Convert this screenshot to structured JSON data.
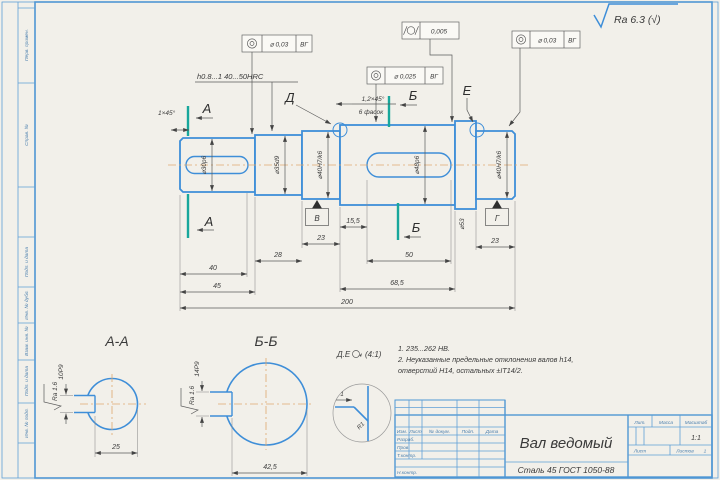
{
  "surface_finish": "Ra 6.3 (√)",
  "shaft_view": {
    "hardness_note": "h0.8...1 40...50HRC",
    "chamfer_left": "1×45°",
    "chamfer_right": "1,2×45°",
    "chamfer_right2": "6 фасок",
    "cut_a": "А",
    "cut_b": "Б",
    "detail_d": "Д",
    "detail_e": "Е",
    "datum_v": "В",
    "datum_g": "Г",
    "dia_30": "⌀30p6",
    "dia_35": "⌀35d9",
    "dia_40_left": "⌀40H7/k6",
    "dia_48": "⌀48p6",
    "dia_53": "⌀53",
    "dia_40_right": "⌀40H7/k6",
    "dim_15_5": "15,5",
    "dim_23_left": "23",
    "dim_28": "28",
    "dim_40": "40",
    "dim_45": "45",
    "dim_50": "50",
    "dim_68_5": "68,5",
    "dim_200": "200",
    "dim_23_right": "23"
  },
  "tolerances": {
    "f1": {
      "value": "⌀ 0,03",
      "datum": "ВГ"
    },
    "f2": {
      "value": "0,005"
    },
    "f3": {
      "value": "⌀ 0,025",
      "datum": "ВГ"
    },
    "f4": {
      "value": "⌀ 0,03",
      "datum": "ВГ"
    }
  },
  "section_aa": {
    "title": "А-А",
    "keyway": "10P9",
    "width": "25",
    "roughness": "Ra 1.6"
  },
  "section_bb": {
    "title": "Б-Б",
    "keyway": "14P9",
    "width": "42,5",
    "roughness": "Ra 1.6"
  },
  "detail": {
    "label": "Д.Е",
    "scale": "(4:1)",
    "radius": "R1",
    "dim": "1"
  },
  "notes": {
    "line1": "1. 235...262 НВ.",
    "line2": "2. Неуказанные предельные отклонения валов h14,",
    "line3": "отверстий Н14, остальных ±IT14/2."
  },
  "title_block": {
    "name": "Вал ведомый",
    "material": "Сталь 45 ГОСТ 1050-88",
    "col_izm": "Изм.",
    "col_list": "Лист",
    "col_dokum": "№ докум.",
    "col_podp": "Подп.",
    "col_data": "Дата",
    "row_razrab": "Разраб.",
    "row_prov": "Пров.",
    "row_tkontr": "Т.контр.",
    "row_nkontr": "Н.контр.",
    "lit": "Лит.",
    "massa": "Масса",
    "masshtab": "Масштаб",
    "scale": "1:1",
    "list": "Лист",
    "listov": "Листов",
    "listov_value": "1"
  },
  "frame_columns": [
    "Перв. примен.",
    "Справ. №",
    "Подп. и дата",
    "Инв. № дубл.",
    "Взам. инв. №",
    "Подп. и дата",
    "Инв. № подл."
  ]
}
